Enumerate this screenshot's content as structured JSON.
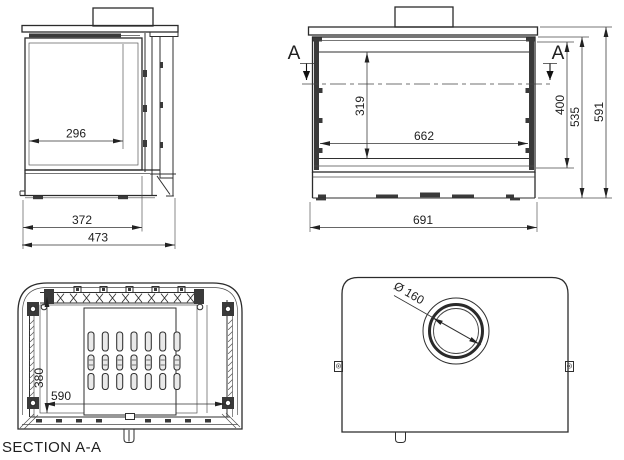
{
  "views": {
    "side": {
      "dims": {
        "glass_depth": "296",
        "body_depth": "372",
        "total_depth": "473"
      }
    },
    "front": {
      "markers": {
        "left": "A",
        "right": "A"
      },
      "dims": {
        "glass_height": "319",
        "glass_width": "662",
        "opening_height": "400",
        "body_height": "535",
        "total_height": "591",
        "total_width": "691"
      }
    },
    "section": {
      "title": "SECTION A-A",
      "dims": {
        "depth": "380",
        "width": "590"
      }
    },
    "top": {
      "dims": {
        "flue_diameter": "Ø 160"
      }
    }
  }
}
